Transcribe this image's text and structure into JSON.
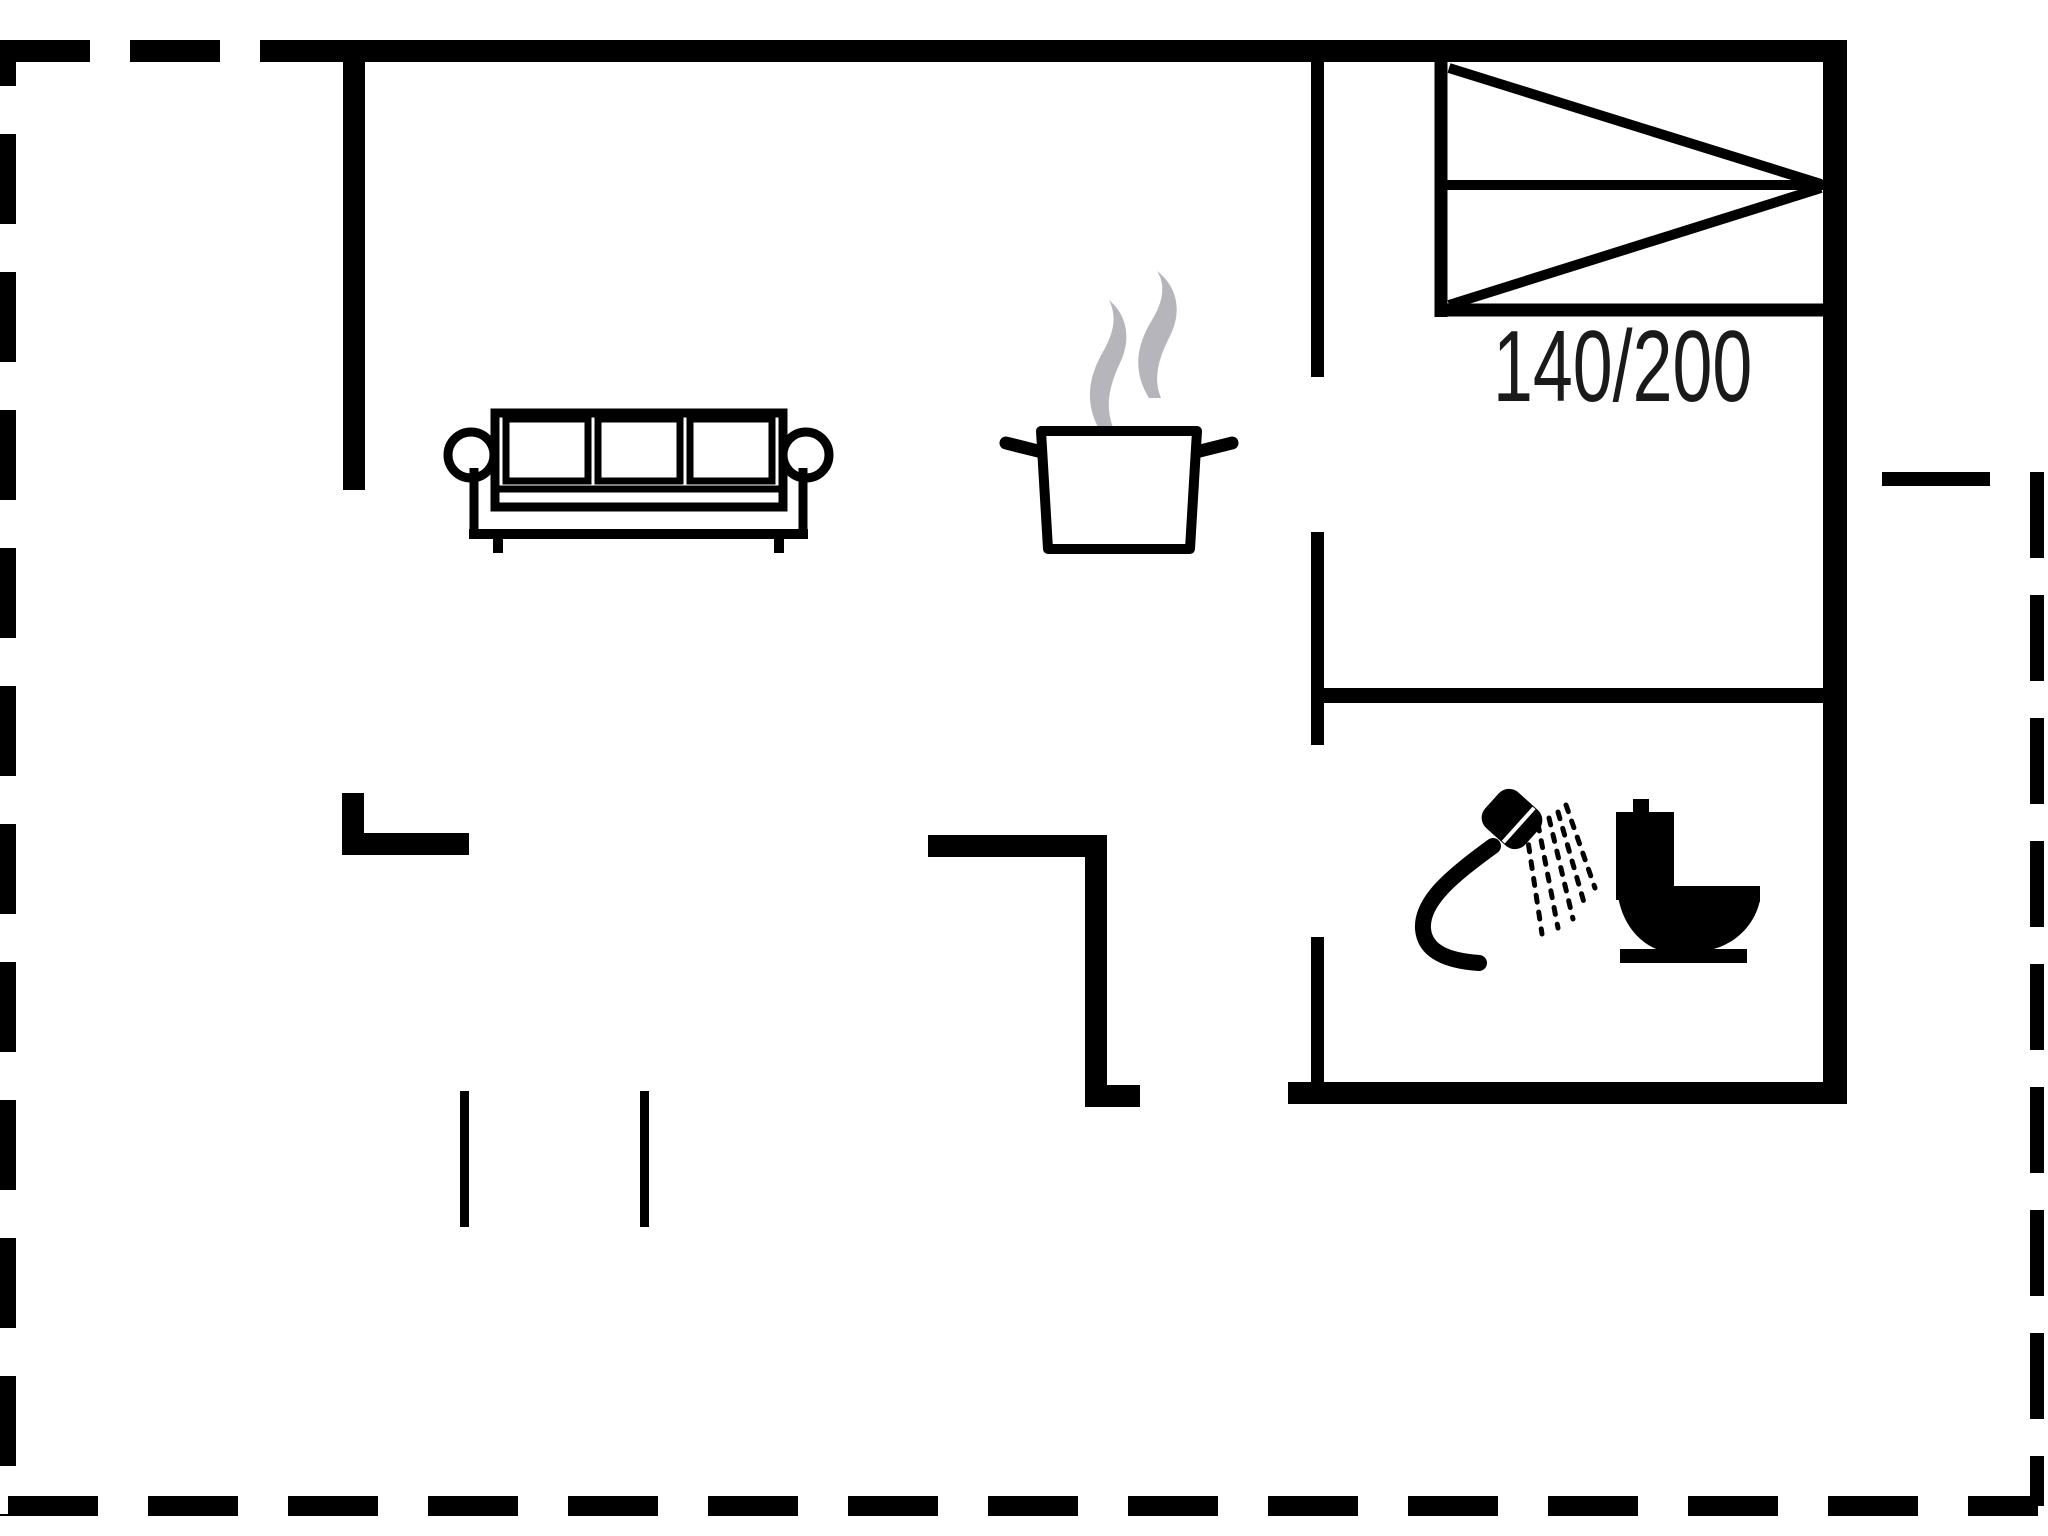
{
  "meta": {
    "type": "floor-plan",
    "description": "Holiday house floor plan: open living room with sofa, kitchen with steaming pot, bedroom with double bed, bathroom with shower and toilet, dashed terrace outline"
  },
  "colors": {
    "line": "#000000",
    "steam": "#b5b5bb",
    "text": "#1a1a1a",
    "background": "#ffffff"
  },
  "bedroom": {
    "bed_label": "140/200"
  },
  "icons": [
    {
      "name": "sofa-icon",
      "glyph": "three-seat sofa outline"
    },
    {
      "name": "steam-icon",
      "glyph": "two grey steam wisps"
    },
    {
      "name": "cooking-pot-icon",
      "glyph": "pot with two handles"
    },
    {
      "name": "double-bed-icon",
      "glyph": "bed rectangle with fold diagonals"
    },
    {
      "name": "shower-icon",
      "glyph": "hand shower with spray"
    },
    {
      "name": "toilet-icon",
      "glyph": "toilet side silhouette"
    }
  ]
}
